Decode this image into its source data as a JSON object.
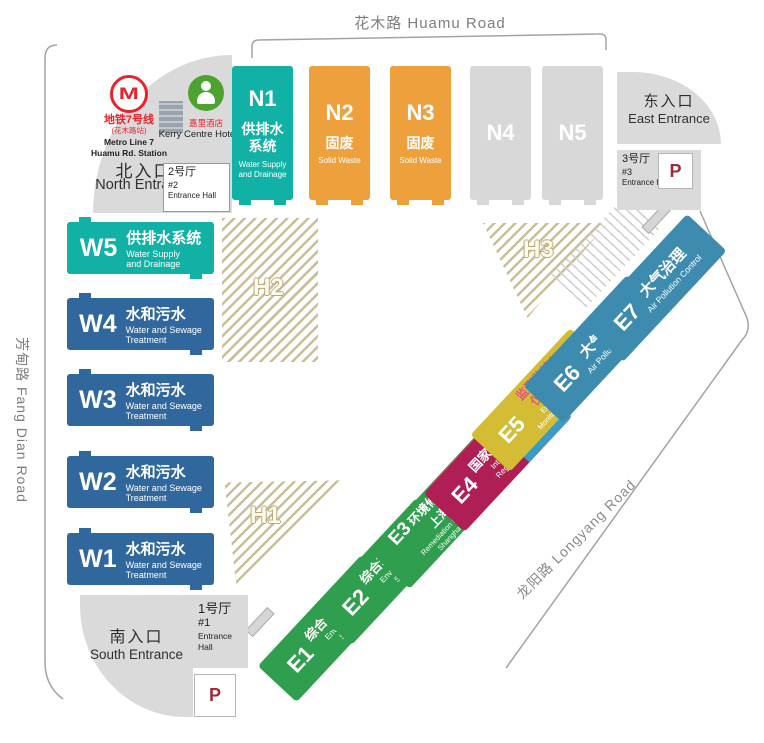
{
  "roads": {
    "top": "花木路 Huamu Road",
    "left": "芳甸路 Fang Dian Road",
    "right": "龙阳路 Longyang Road"
  },
  "north_entrance": {
    "metro_logo_glyph": "M",
    "metro_line_cn": "地铁7号线",
    "metro_station_cn": "(花木路站)",
    "metro_line_en": "Metro Line 7",
    "metro_station_en": "Huamu Rd. Station",
    "hotel_cn": "嘉里酒店",
    "hotel_en": "Kerry Centre Hotel",
    "title_cn": "北入口",
    "title_en": "North Entrance",
    "hall": {
      "cn": "2号厅",
      "num": "#2",
      "en": "Entrance Hall"
    }
  },
  "east_entrance": {
    "title_cn": "东入口",
    "title_en": "East Entrance",
    "hall": {
      "cn": "3号厅",
      "num": "#3",
      "en": "Entrance Hall"
    },
    "parking_glyph": "P"
  },
  "south_entrance": {
    "title_cn": "南入口",
    "title_en": "South Entrance",
    "hall": {
      "cn": "1号厅",
      "num": "#1",
      "en": "Entrance Hall"
    },
    "parking_glyph": "P"
  },
  "north_halls": [
    {
      "id": "N1",
      "cn": "供排水\n系统",
      "en": "Water Supply\nand Drainage",
      "color": "#12b1a5"
    },
    {
      "id": "N2",
      "cn": "固废",
      "en": "Solid Waste",
      "color": "#eda03c"
    },
    {
      "id": "N3",
      "cn": "固废",
      "en": "Solid Waste",
      "color": "#eda03c"
    },
    {
      "id": "N4",
      "color": "#d8d8d9"
    },
    {
      "id": "N5",
      "color": "#d8d8d9"
    }
  ],
  "west_halls": [
    {
      "id": "W5",
      "cn": "供排水系统",
      "en": "Water Supply\nand Drainage",
      "color": "#12b1a5"
    },
    {
      "id": "W4",
      "cn": "水和污水",
      "en": "Water and Sewage\nTreatment",
      "color": "#30689e"
    },
    {
      "id": "W3",
      "cn": "水和污水",
      "en": "Water and Sewage\nTreatment",
      "color": "#30689e"
    },
    {
      "id": "W2",
      "cn": "水和污水",
      "en": "Water and Sewage\nTreatment",
      "color": "#30689e"
    },
    {
      "id": "W1",
      "cn": "水和污水",
      "en": "Water and Sewage\nTreatment",
      "color": "#30689e"
    }
  ],
  "east_halls": [
    {
      "id": "E1",
      "cn": "综合环境服务",
      "en": "Environmental\nServices",
      "color": "#2f9e4e"
    },
    {
      "id": "E2",
      "cn": "综合环境服务",
      "en": "Environmental\nServices",
      "color": "#2f9e4e"
    },
    {
      "id": "E3",
      "cn": "环境修复与噪声",
      "cn2": "上海馆",
      "en": "Remediation Noise Control\nShanghai Pavilion",
      "color": "#2f9e4e",
      "accent1": "#8a6f4b",
      "accent2": "#d41b8c"
    },
    {
      "id": "E4",
      "cn": "国家与地区展团",
      "en": "International and\nRegional Pavilions",
      "color": "#b01e56",
      "accent1": "#ddc53a",
      "accent2": "#3a9cc4"
    },
    {
      "id": "E5",
      "cn": "监测监控与\n仪器仪表",
      "en": "Environmental\nMonitoring and Control",
      "color": "#d4bd35",
      "cn_color": "#e25878"
    },
    {
      "id": "E6",
      "cn": "大气治理",
      "en": "Air Pollution Control",
      "color": "#3d8cb0"
    },
    {
      "id": "E7",
      "cn": "大气治理",
      "en": "Air Pollution Control",
      "color": "#3d8cb0"
    }
  ],
  "zones": {
    "h1": "H1",
    "h2": "H2",
    "h3": "H3"
  }
}
